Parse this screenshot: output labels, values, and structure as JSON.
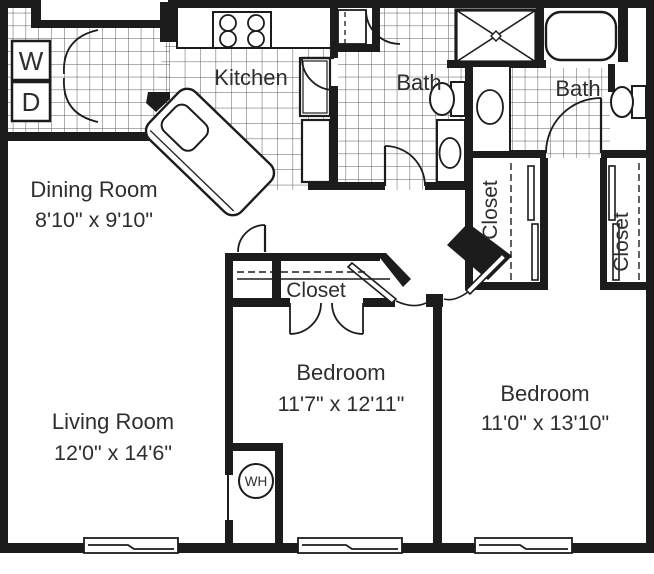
{
  "plan": {
    "title": "Two bedroom apartment floor plan",
    "rooms": {
      "kitchen": {
        "label": "Kitchen"
      },
      "dining": {
        "label": "Dining Room",
        "dims": "8'10\" x 9'10\""
      },
      "living": {
        "label": "Living Room",
        "dims": "12'0\" x 14'6\""
      },
      "bath_left": {
        "label": "Bath"
      },
      "bath_right": {
        "label": "Bath"
      },
      "bedroom_middle": {
        "label": "Bedroom",
        "dims": "11'7\" x 12'11\""
      },
      "bedroom_right": {
        "label": "Bedroom",
        "dims": "11'0\" x 13'10\""
      },
      "closet_middle": {
        "label": "Closet"
      },
      "closet_left": {
        "label": "Closet"
      },
      "closet_right": {
        "label": "Closet"
      }
    },
    "appliances": {
      "washer": "W",
      "dryer": "D",
      "water_heater": "WH"
    },
    "colors": {
      "wall": "#1c1c1c",
      "tile_line": "#5a5a5a",
      "text": "#2e2e2e",
      "background": "#ffffff"
    }
  }
}
